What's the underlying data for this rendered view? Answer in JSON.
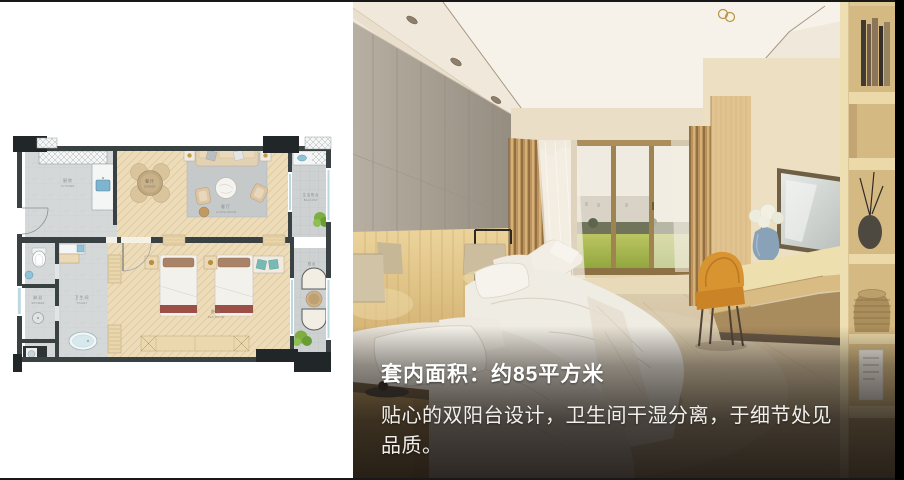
{
  "slide": {
    "background": "#ffffff",
    "frame_color": "#181818"
  },
  "floor_plan": {
    "rooms": {
      "kitchen": {
        "zh": "厨房",
        "en": "KITCHEN"
      },
      "dining": {
        "zh": "餐厅",
        "en": "DINNER"
      },
      "living": {
        "zh": "客厅",
        "en": "LIVING ROOM"
      },
      "bedroom": {
        "zh": "卧室",
        "en": "BED ROOM"
      },
      "toilet": {
        "zh": "卫生间",
        "en": "TOILET"
      },
      "shower": {
        "zh": "淋浴",
        "en": "SHOWER"
      },
      "balcony_top": {
        "zh": "生活阳台",
        "en": "BALCONY"
      },
      "balcony_bottom": {
        "zh": "阳台"
      }
    },
    "colors": {
      "wall": "#3a4143",
      "corner_block": "#212628",
      "wood_floor": "#ecdcba",
      "tile": "#ced1d2",
      "rug": "#c6c9ca",
      "bed_runner_red": "#9b4f46",
      "pillow_brown": "#a98268",
      "cushion_teal": "#77b9b4",
      "plant_green": "#7fae40",
      "sink_blue": "#7fb4cf",
      "glazing_blue": "#bcd9e0"
    }
  },
  "photo": {
    "caption": {
      "title": "套内面积：约85平方米",
      "body_lines": [
        "贴心的双阳台设计，卫生间干湿分离，于细节处见",
        "品质。"
      ]
    },
    "colors": {
      "stone_wall": "#a8a093",
      "headboard_wood": "#d9bd84",
      "drape_gold": "#bb9160",
      "lawn_green": "#a7b84e",
      "chair_orange": "#d08a2b",
      "shelf_wood": "#e3cd9c",
      "overlay_dark": "#1e1611"
    }
  }
}
